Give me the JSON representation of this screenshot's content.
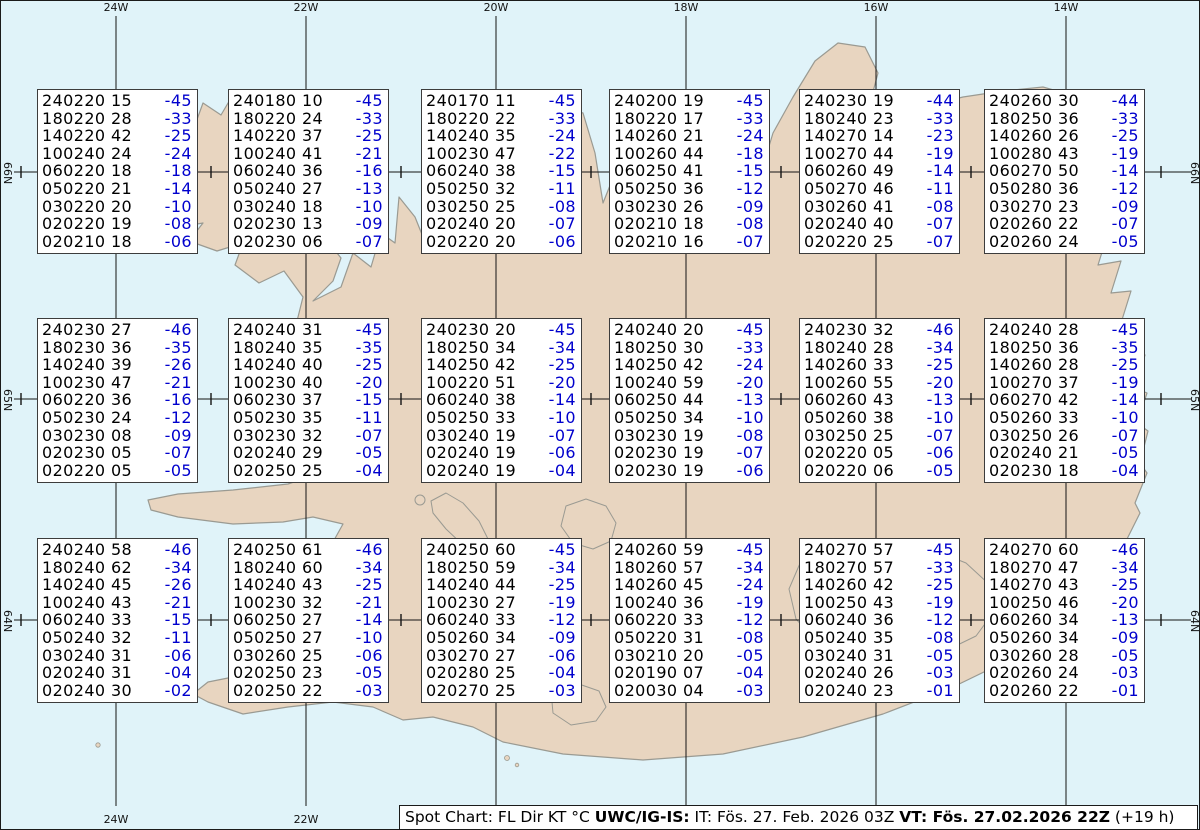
{
  "map": {
    "sea_color": "#e0f3f9",
    "land_color": "#e8d5c0",
    "coast_color": "#9a9a92",
    "grid_color": "#141414",
    "lon_labels": [
      {
        "text": "24W",
        "x": 115
      },
      {
        "text": "22W",
        "x": 305
      },
      {
        "text": "20W",
        "x": 495
      },
      {
        "text": "18W",
        "x": 685
      },
      {
        "text": "16W",
        "x": 875
      },
      {
        "text": "14W",
        "x": 1065
      }
    ],
    "bottom_lon_labels": [
      {
        "text": "24W",
        "x": 115
      },
      {
        "text": "22W",
        "x": 305
      }
    ],
    "lat_labels": [
      {
        "text": "66N",
        "y": 171
      },
      {
        "text": "65N",
        "y": 398
      },
      {
        "text": "64N",
        "y": 619
      }
    ],
    "minor_cross_x": [
      20,
      210,
      400,
      590,
      780,
      970,
      1160
    ]
  },
  "colors": {
    "wind_text": "#000000",
    "temp_text": "#0000cd"
  },
  "caption": {
    "prefix": "Spot Chart: FL Dir KT °C ",
    "bold1": "UWC/IG-IS:",
    "mid": " IT: Fös. 27. Feb. 2026 03Z ",
    "bold2": "VT: Fös. 27.02.2026 22Z",
    "suffix": " (+19 h)"
  },
  "chart_data": {
    "type": "table",
    "title": "Spot Chart: FL Dir KT °C",
    "columns": [
      "FL+Dir Speed",
      "Temp"
    ],
    "note": "18 spot boxes over Iceland, rows = FL240..FL020"
  },
  "spots": [
    {
      "row": 0,
      "col": 0,
      "lines": [
        [
          "240220 15",
          "-45"
        ],
        [
          "180220 28",
          "-33"
        ],
        [
          "140220 42",
          "-25"
        ],
        [
          "100240 24",
          "-24"
        ],
        [
          "060220 18",
          "-18"
        ],
        [
          "050220 21",
          "-14"
        ],
        [
          "030220 20",
          "-10"
        ],
        [
          "020220 19",
          "-08"
        ],
        [
          "020210 18",
          "-06"
        ]
      ]
    },
    {
      "row": 0,
      "col": 1,
      "lines": [
        [
          "240180 10",
          "-45"
        ],
        [
          "180220 24",
          "-33"
        ],
        [
          "140220 37",
          "-25"
        ],
        [
          "100240 41",
          "-21"
        ],
        [
          "060240 36",
          "-16"
        ],
        [
          "050240 27",
          "-13"
        ],
        [
          "030240 18",
          "-10"
        ],
        [
          "020230 13",
          "-09"
        ],
        [
          "020230 06",
          "-07"
        ]
      ]
    },
    {
      "row": 0,
      "col": 2,
      "lines": [
        [
          "240170 11",
          "-45"
        ],
        [
          "180220 22",
          "-33"
        ],
        [
          "140240 35",
          "-24"
        ],
        [
          "100230 47",
          "-22"
        ],
        [
          "060240 38",
          "-15"
        ],
        [
          "050250 32",
          "-11"
        ],
        [
          "030250 25",
          "-08"
        ],
        [
          "020240 20",
          "-07"
        ],
        [
          "020220 20",
          "-06"
        ]
      ]
    },
    {
      "row": 0,
      "col": 3,
      "lines": [
        [
          "240200 19",
          "-45"
        ],
        [
          "180220 17",
          "-33"
        ],
        [
          "140260 21",
          "-24"
        ],
        [
          "100260 44",
          "-18"
        ],
        [
          "060250 41",
          "-15"
        ],
        [
          "050250 36",
          "-12"
        ],
        [
          "030230 26",
          "-09"
        ],
        [
          "020210 18",
          "-08"
        ],
        [
          "020210 16",
          "-07"
        ]
      ]
    },
    {
      "row": 0,
      "col": 4,
      "lines": [
        [
          "240230 19",
          "-44"
        ],
        [
          "180240 23",
          "-33"
        ],
        [
          "140270 14",
          "-23"
        ],
        [
          "100270 44",
          "-19"
        ],
        [
          "060260 49",
          "-14"
        ],
        [
          "050270 46",
          "-11"
        ],
        [
          "030260 41",
          "-08"
        ],
        [
          "020240 40",
          "-07"
        ],
        [
          "020220 25",
          "-07"
        ]
      ]
    },
    {
      "row": 0,
      "col": 5,
      "lines": [
        [
          "240260 30",
          "-44"
        ],
        [
          "180250 36",
          "-33"
        ],
        [
          "140260 26",
          "-25"
        ],
        [
          "100280 43",
          "-19"
        ],
        [
          "060270 50",
          "-14"
        ],
        [
          "050280 36",
          "-12"
        ],
        [
          "030270 23",
          "-09"
        ],
        [
          "020260 22",
          "-07"
        ],
        [
          "020260 24",
          "-05"
        ]
      ]
    },
    {
      "row": 1,
      "col": 0,
      "lines": [
        [
          "240230 27",
          "-46"
        ],
        [
          "180230 36",
          "-35"
        ],
        [
          "140240 39",
          "-26"
        ],
        [
          "100230 47",
          "-21"
        ],
        [
          "060220 36",
          "-16"
        ],
        [
          "050230 24",
          "-12"
        ],
        [
          "030230 08",
          "-09"
        ],
        [
          "020230 05",
          "-07"
        ],
        [
          "020220 05",
          "-05"
        ]
      ]
    },
    {
      "row": 1,
      "col": 1,
      "lines": [
        [
          "240240 31",
          "-45"
        ],
        [
          "180240 35",
          "-35"
        ],
        [
          "140240 40",
          "-25"
        ],
        [
          "100230 40",
          "-20"
        ],
        [
          "060230 37",
          "-15"
        ],
        [
          "050230 35",
          "-11"
        ],
        [
          "030230 32",
          "-07"
        ],
        [
          "020240 29",
          "-05"
        ],
        [
          "020250 25",
          "-04"
        ]
      ]
    },
    {
      "row": 1,
      "col": 2,
      "lines": [
        [
          "240230 20",
          "-45"
        ],
        [
          "180250 34",
          "-34"
        ],
        [
          "140250 42",
          "-25"
        ],
        [
          "100220 51",
          "-20"
        ],
        [
          "060240 38",
          "-14"
        ],
        [
          "050250 33",
          "-10"
        ],
        [
          "030240 19",
          "-07"
        ],
        [
          "020240 19",
          "-06"
        ],
        [
          "020240 19",
          "-04"
        ]
      ]
    },
    {
      "row": 1,
      "col": 3,
      "lines": [
        [
          "240240 20",
          "-45"
        ],
        [
          "180250 30",
          "-33"
        ],
        [
          "140250 42",
          "-24"
        ],
        [
          "100240 59",
          "-20"
        ],
        [
          "060250 44",
          "-13"
        ],
        [
          "050250 34",
          "-10"
        ],
        [
          "030230 19",
          "-08"
        ],
        [
          "020230 19",
          "-07"
        ],
        [
          "020230 19",
          "-06"
        ]
      ]
    },
    {
      "row": 1,
      "col": 4,
      "lines": [
        [
          "240230 32",
          "-46"
        ],
        [
          "180240 28",
          "-34"
        ],
        [
          "140260 33",
          "-25"
        ],
        [
          "100260 55",
          "-20"
        ],
        [
          "060260 43",
          "-13"
        ],
        [
          "050260 38",
          "-10"
        ],
        [
          "030250 25",
          "-07"
        ],
        [
          "020220 05",
          "-06"
        ],
        [
          "020220 06",
          "-05"
        ]
      ]
    },
    {
      "row": 1,
      "col": 5,
      "lines": [
        [
          "240240 28",
          "-45"
        ],
        [
          "180250 36",
          "-35"
        ],
        [
          "140260 28",
          "-25"
        ],
        [
          "100270 37",
          "-19"
        ],
        [
          "060270 42",
          "-14"
        ],
        [
          "050260 33",
          "-10"
        ],
        [
          "030250 26",
          "-07"
        ],
        [
          "020240 21",
          "-05"
        ],
        [
          "020230 18",
          "-04"
        ]
      ]
    },
    {
      "row": 2,
      "col": 0,
      "lines": [
        [
          "240240 58",
          "-46"
        ],
        [
          "180240 62",
          "-34"
        ],
        [
          "140240 45",
          "-26"
        ],
        [
          "100240 43",
          "-21"
        ],
        [
          "060240 33",
          "-15"
        ],
        [
          "050240 32",
          "-11"
        ],
        [
          "030240 31",
          "-06"
        ],
        [
          "020240 31",
          "-04"
        ],
        [
          "020240 30",
          "-02"
        ]
      ]
    },
    {
      "row": 2,
      "col": 1,
      "lines": [
        [
          "240250 61",
          "-46"
        ],
        [
          "180240 60",
          "-34"
        ],
        [
          "140240 43",
          "-25"
        ],
        [
          "100230 32",
          "-21"
        ],
        [
          "060250 27",
          "-14"
        ],
        [
          "050250 27",
          "-10"
        ],
        [
          "030260 25",
          "-06"
        ],
        [
          "020250 23",
          "-05"
        ],
        [
          "020250 22",
          "-03"
        ]
      ]
    },
    {
      "row": 2,
      "col": 2,
      "lines": [
        [
          "240250 60",
          "-45"
        ],
        [
          "180250 59",
          "-34"
        ],
        [
          "140240 44",
          "-25"
        ],
        [
          "100230 27",
          "-19"
        ],
        [
          "060240 33",
          "-12"
        ],
        [
          "050260 34",
          "-09"
        ],
        [
          "030270 27",
          "-06"
        ],
        [
          "020280 25",
          "-04"
        ],
        [
          "020270 25",
          "-03"
        ]
      ]
    },
    {
      "row": 2,
      "col": 3,
      "lines": [
        [
          "240260 59",
          "-45"
        ],
        [
          "180260 57",
          "-34"
        ],
        [
          "140260 45",
          "-24"
        ],
        [
          "100240 36",
          "-19"
        ],
        [
          "060220 33",
          "-12"
        ],
        [
          "050220 31",
          "-08"
        ],
        [
          "030210 20",
          "-05"
        ],
        [
          "020190 07",
          "-04"
        ],
        [
          "020030 04",
          "-03"
        ]
      ]
    },
    {
      "row": 2,
      "col": 4,
      "lines": [
        [
          "240270 57",
          "-45"
        ],
        [
          "180270 57",
          "-33"
        ],
        [
          "140260 42",
          "-25"
        ],
        [
          "100250 43",
          "-19"
        ],
        [
          "060240 36",
          "-12"
        ],
        [
          "050240 35",
          "-08"
        ],
        [
          "030240 31",
          "-05"
        ],
        [
          "020240 26",
          "-03"
        ],
        [
          "020240 23",
          "-01"
        ]
      ]
    },
    {
      "row": 2,
      "col": 5,
      "lines": [
        [
          "240270 60",
          "-46"
        ],
        [
          "180270 47",
          "-34"
        ],
        [
          "140270 43",
          "-25"
        ],
        [
          "100250 46",
          "-20"
        ],
        [
          "060260 34",
          "-13"
        ],
        [
          "050260 34",
          "-09"
        ],
        [
          "030260 28",
          "-05"
        ],
        [
          "020260 24",
          "-03"
        ],
        [
          "020260 22",
          "-01"
        ]
      ]
    }
  ]
}
